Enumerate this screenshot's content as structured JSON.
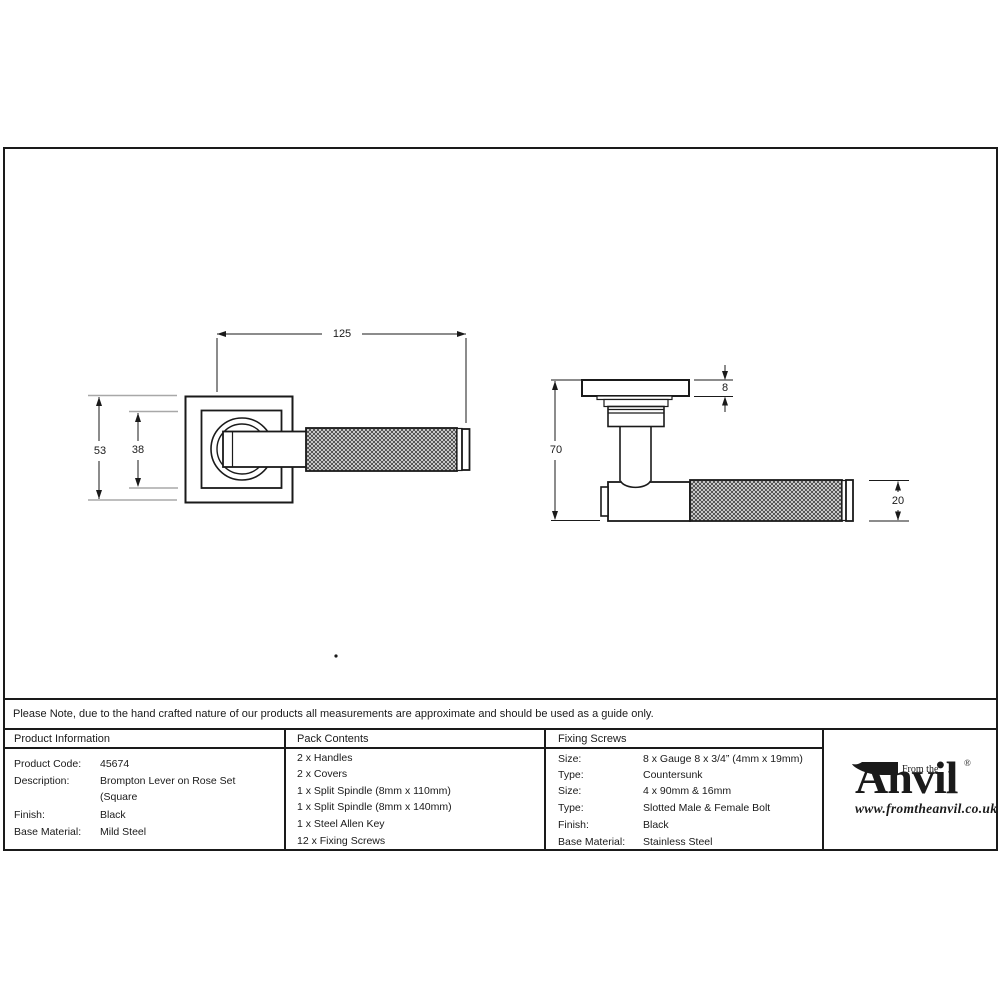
{
  "note": {
    "text": "Please Note, due to the hand crafted nature of our products all measurements are approximate and should be used as a guide only."
  },
  "drawings": {
    "front_view": {
      "lever_length": "125",
      "rose_height": "53",
      "rose_inner_height": "38"
    },
    "side_view": {
      "projection": "70",
      "rose_thickness": "8",
      "lever_diameter": "20"
    }
  },
  "table": {
    "product_info": {
      "header": "Product Information",
      "rows": [
        {
          "label": "Product Code:",
          "value": "45674"
        },
        {
          "label": "Description:",
          "value": "Brompton Lever on Rose Set"
        },
        {
          "label": "",
          "value": "(Square"
        },
        {
          "label": "Finish:",
          "value": "Black"
        },
        {
          "label": "Base Material:",
          "value": "Mild Steel"
        }
      ]
    },
    "pack_contents": {
      "header": "Pack Contents",
      "items": [
        "2 x Handles",
        "2 x Covers",
        "1 x Split Spindle (8mm x 110mm)",
        "1 x Split Spindle (8mm x 140mm)",
        "1 x Steel Allen Key",
        "12 x Fixing Screws"
      ]
    },
    "fixing_screws": {
      "header": "Fixing Screws",
      "rows": [
        {
          "label": "Size:",
          "value": "8 x Gauge 8 x 3/4” (4mm x 19mm)"
        },
        {
          "label": "Type:",
          "value": "Countersunk"
        },
        {
          "label": "Size:",
          "value": "4 x 90mm & 16mm"
        },
        {
          "label": "Type:",
          "value": "Slotted Male & Female Bolt"
        },
        {
          "label": "Finish:",
          "value": "Black"
        },
        {
          "label": "Base Material:",
          "value": "Stainless Steel"
        }
      ]
    }
  },
  "logo": {
    "tagline": "From the",
    "brand_initial": "A",
    "brand_rest": "nvil",
    "registered_mark": "®",
    "diamond": "◆",
    "website": "www.fromtheanvil.co.uk"
  },
  "colors": {
    "line": "#1a1a1a",
    "extension_line": "#a8a8a8",
    "background": "#ffffff"
  }
}
